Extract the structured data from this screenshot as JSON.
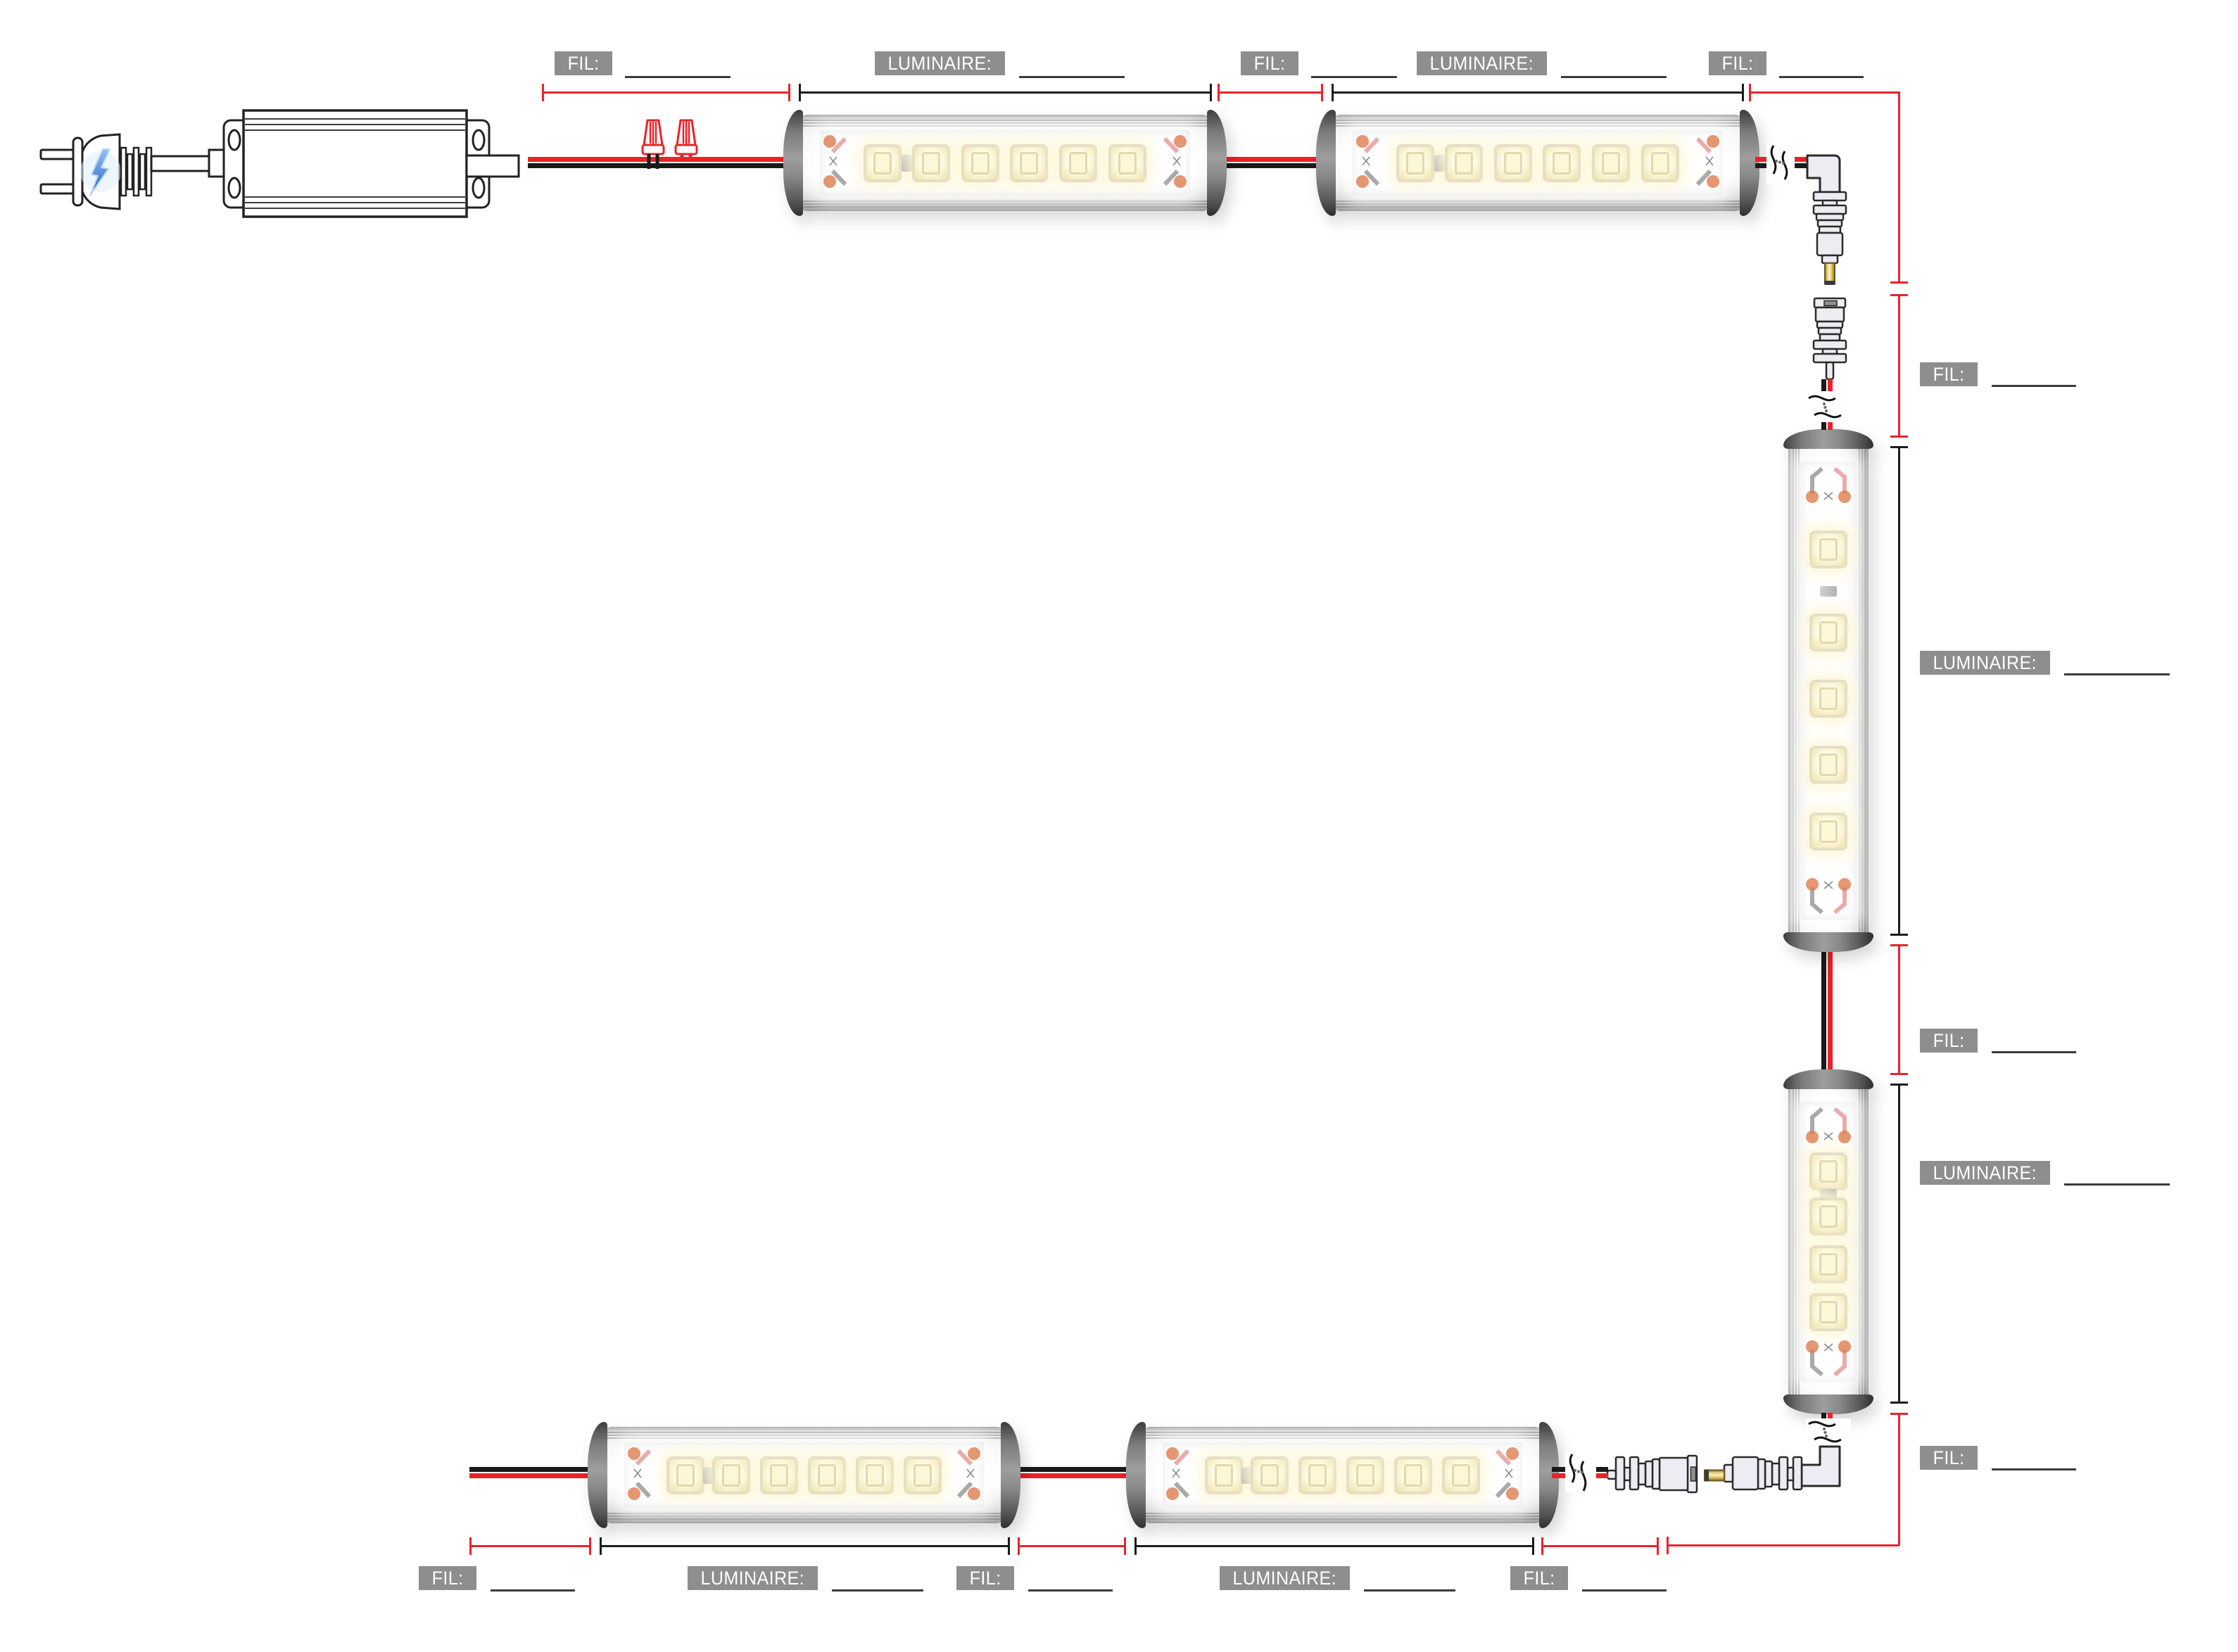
{
  "labels": {
    "fil": "FIL:",
    "luminaire": "LUMINAIRE:",
    "blank_value": ""
  },
  "colors": {
    "dimension_red": "#e8232b",
    "dimension_black": "#1c1c1c",
    "wire_red": "#e8232b",
    "wire_black": "#1a1a1a",
    "label_background": "#8e8e8e",
    "label_text": "#ffffff",
    "underline": "#3a3a3a",
    "connector_gold": "#d9b44a",
    "plug_bolt_blue": "#4a86d8"
  },
  "components": {
    "power_plug": "two-prong-plug-icon",
    "power_supply": "led-driver-box",
    "wire_connector_count": 2,
    "luminaire_count": 6,
    "dc_connector_pairs": 2
  },
  "annotations": {
    "top": [
      {
        "type": "fil",
        "value": ""
      },
      {
        "type": "luminaire",
        "value": ""
      },
      {
        "type": "fil",
        "value": ""
      },
      {
        "type": "luminaire",
        "value": ""
      },
      {
        "type": "fil",
        "value": ""
      }
    ],
    "right": [
      {
        "type": "fil",
        "value": ""
      },
      {
        "type": "luminaire",
        "value": ""
      },
      {
        "type": "fil",
        "value": ""
      },
      {
        "type": "luminaire",
        "value": ""
      },
      {
        "type": "fil",
        "value": ""
      }
    ],
    "bottom": [
      {
        "type": "fil",
        "value": ""
      },
      {
        "type": "luminaire",
        "value": ""
      },
      {
        "type": "fil",
        "value": ""
      },
      {
        "type": "luminaire",
        "value": ""
      },
      {
        "type": "fil",
        "value": ""
      }
    ]
  }
}
